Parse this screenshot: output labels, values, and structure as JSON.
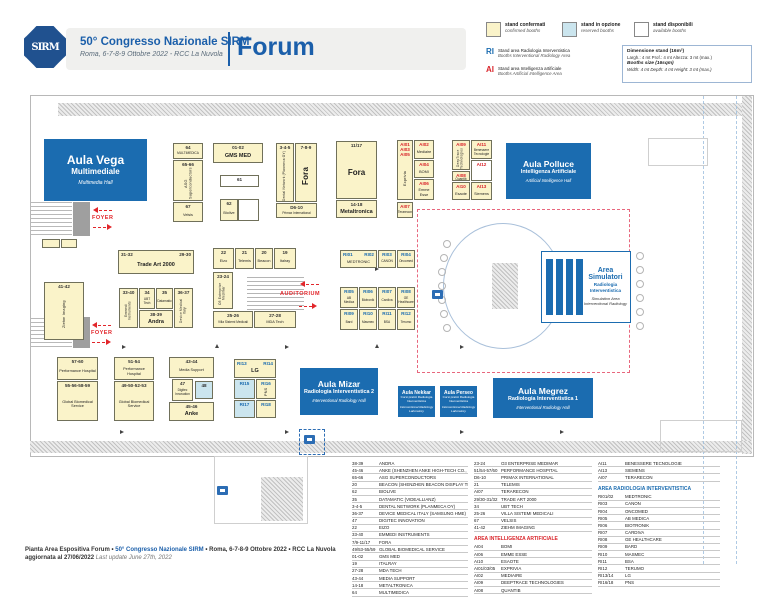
{
  "header": {
    "logo": "SIRM",
    "congress": "50° Congresso Nazionale SIRM",
    "dates": "Roma, 6-7-8-9 Ottobre 2022 - RCC La Nuvola",
    "page": "Forum"
  },
  "legend": {
    "confirmed_it": "stand confermati",
    "confirmed_en": "confirmed booths",
    "option_it": "stand in opzione",
    "option_en": "reserved booths",
    "available_it": "stand disponibili",
    "available_en": "available booths",
    "ri_code": "RI",
    "ri_it": "Stand area Radiologia Interventistica",
    "ri_en": "Booths Interventional Radiology Area",
    "ai_code": "AI",
    "ai_it": "Stand area Intelligenza artificiale",
    "ai_en": "Booths Artificial Intelligence Area",
    "colors": {
      "confirmed": "#FAF3C9",
      "option": "#CBE5EE",
      "available": "#FFFFFF",
      "ri": "#1B6CB0",
      "ai": "#D9252B"
    }
  },
  "dims": {
    "t1": "Dimensione stand (16m²)",
    "t2": "Largh.: 4 mt   Prof.: 4 mt   Altezza: 3 mt (max.)",
    "t3": "Booths size (16sqm)",
    "t4": "Width: 4 mt   Depth: 4 mt   Height: 3 mt (max.)"
  },
  "map": {
    "labels": {
      "foyer": "FOYER",
      "auditorium": "AUDITORIUM"
    },
    "sim": {
      "title": "Area Simulatori",
      "sub1": "Radiologia",
      "sub2": "Interventistica",
      "eng1": "Simulation Area",
      "eng2": "Interventional Radiology"
    },
    "halls": [
      {
        "cls": "lg",
        "title": "Aula Vega",
        "sub": "Multimediale",
        "eng": "Multimedia Hall",
        "x": 44,
        "y": 139,
        "w": 103,
        "h": 62
      },
      {
        "cls": "md",
        "title": "Aula Polluce",
        "sub": "Intelligenza Artificiale",
        "eng": "Artificial Intelligence Hall",
        "x": 506,
        "y": 143,
        "w": 85,
        "h": 56
      },
      {
        "cls": "md",
        "title": "Aula Mizar",
        "sub": "Radiologia Interventistica 2",
        "eng": "Interventional Radiology Hall",
        "x": 300,
        "y": 368,
        "w": 78,
        "h": 47
      },
      {
        "cls": "sm",
        "title": "Aula Nekkar",
        "sub": "Corsi pratici Radiologia Interventistica",
        "eng": "Interventional Radiology Laboratory",
        "x": 398,
        "y": 386,
        "w": 37,
        "h": 31
      },
      {
        "cls": "sm",
        "title": "Aula Perseo",
        "sub": "Corsi pratici Radiologia Interventistica",
        "eng": "Interventional Radiology Laboratory",
        "x": 440,
        "y": 386,
        "w": 37,
        "h": 31
      },
      {
        "cls": "md",
        "title": "Aula Megrez",
        "sub": "Radiologia Interventistica 1",
        "eng": "Interventional Radiology Hall",
        "x": 493,
        "y": 378,
        "w": 100,
        "h": 40
      }
    ],
    "booths": [
      {
        "id": "64",
        "name": "MULTIMEDICA",
        "x": 173,
        "y": 143,
        "w": 30,
        "h": 16,
        "ns": true
      },
      {
        "id": "65-66",
        "name": "ASG Superconductors",
        "x": 173,
        "y": 160,
        "w": 30,
        "h": 41,
        "vert": true
      },
      {
        "id": "67",
        "name": "Velsis",
        "x": 173,
        "y": 202,
        "w": 30,
        "h": 20
      },
      {
        "id": "01-02",
        "name": "GMS MED",
        "x": 213,
        "y": 143,
        "w": 50,
        "h": 20,
        "big": true
      },
      {
        "id": "61",
        "x": 220,
        "y": 175,
        "w": 39,
        "h": 12,
        "k": "w"
      },
      {
        "id": "62",
        "name": "Biolive",
        "x": 220,
        "y": 199,
        "w": 18,
        "h": 22
      },
      {
        "x": 238,
        "y": 199,
        "w": 21,
        "h": 22,
        "k": "w"
      },
      {
        "id": "3-4-5",
        "name": "Dental Network (Planmeca OY)",
        "x": 276,
        "y": 143,
        "w": 18,
        "h": 59,
        "vert": true,
        "ns": true
      },
      {
        "id": "7-8-9",
        "name": "Fora",
        "x": 295,
        "y": 143,
        "w": 22,
        "h": 59,
        "vert": true,
        "big": "xl"
      },
      {
        "id": "D6-10",
        "name": "Primax International",
        "x": 276,
        "y": 203,
        "w": 41,
        "h": 15,
        "ns": true
      },
      {
        "id": "11/17",
        "name": "Fora",
        "x": 336,
        "y": 141,
        "w": 41,
        "h": 58,
        "big": "xl"
      },
      {
        "id": "14-18",
        "name": "Metaltronica",
        "x": 336,
        "y": 200,
        "w": 41,
        "h": 18,
        "big": true
      },
      {
        "id": "AI01\nAI03\nAI05",
        "c": "ai",
        "name": "Exprivia",
        "x": 397,
        "y": 140,
        "w": 16,
        "h": 60,
        "vert": true
      },
      {
        "id": "AI02",
        "c": "ai",
        "name": "Mediaire",
        "x": 414,
        "y": 140,
        "w": 20,
        "h": 19
      },
      {
        "id": "AI04",
        "c": "ai",
        "name": "BOMI",
        "x": 414,
        "y": 160,
        "w": 20,
        "h": 18
      },
      {
        "id": "AI06",
        "c": "ai",
        "name": "Emme Esse",
        "x": 414,
        "y": 179,
        "w": 20,
        "h": 21
      },
      {
        "id": "AI07",
        "c": "ai",
        "name": "Terarecon",
        "x": 397,
        "y": 202,
        "w": 16,
        "h": 16,
        "ns": true
      },
      {
        "id": "AI09",
        "c": "ai",
        "name": "DeepTrace Technologies",
        "x": 452,
        "y": 140,
        "w": 18,
        "h": 30,
        "vert": true,
        "ns": true
      },
      {
        "id": "AI11",
        "c": "ai",
        "name": "Benessere Tecnologie",
        "x": 471,
        "y": 140,
        "w": 21,
        "h": 19,
        "ns": true
      },
      {
        "id": "AI08",
        "c": "ai",
        "name": "Quantib",
        "x": 452,
        "y": 171,
        "w": 18,
        "h": 10,
        "ns": true
      },
      {
        "id": "AI12",
        "c": "ai",
        "x": 471,
        "y": 160,
        "w": 21,
        "h": 21,
        "k": "w"
      },
      {
        "id": "AI10",
        "c": "ai",
        "name": "Esaote",
        "x": 452,
        "y": 182,
        "w": 18,
        "h": 18
      },
      {
        "id": "AI13",
        "c": "ai",
        "name": "Siemens",
        "x": 471,
        "y": 182,
        "w": 21,
        "h": 18
      },
      {
        "id": "41-42",
        "name": "Ziehm Imaging",
        "x": 44,
        "y": 282,
        "w": 40,
        "h": 58,
        "vert": true
      },
      {
        "id": "31-32",
        "id2": "29-30",
        "name": "Trade Art 2000",
        "x": 118,
        "y": 250,
        "w": 76,
        "h": 24,
        "big": true
      },
      {
        "id": "33-40",
        "name": "Emmedi Instruments",
        "x": 119,
        "y": 288,
        "w": 19,
        "h": 40,
        "vert": true,
        "ns": true
      },
      {
        "id": "34",
        "name": "UBT Tech",
        "x": 139,
        "y": 288,
        "w": 16,
        "h": 21,
        "ns": true
      },
      {
        "id": "35",
        "name": "Datamatic",
        "x": 156,
        "y": 288,
        "w": 17,
        "h": 21,
        "ns": true
      },
      {
        "id": "36-37",
        "name": "Device Medical Italy",
        "x": 174,
        "y": 288,
        "w": 19,
        "h": 40,
        "vert": true,
        "ns": true
      },
      {
        "id": "38-39",
        "name": "Andra",
        "x": 139,
        "y": 310,
        "w": 34,
        "h": 18,
        "big": true
      },
      {
        "id": "22",
        "name": "Eizo",
        "x": 213,
        "y": 248,
        "w": 21,
        "h": 21
      },
      {
        "id": "21",
        "name": "Telemis",
        "x": 235,
        "y": 248,
        "w": 19,
        "h": 21
      },
      {
        "id": "20",
        "name": "Beacon",
        "x": 255,
        "y": 248,
        "w": 18,
        "h": 21
      },
      {
        "id": "19",
        "name": "Italray",
        "x": 274,
        "y": 248,
        "w": 22,
        "h": 21
      },
      {
        "id": "23-24",
        "name": "O3 Enterprise Medimar",
        "x": 213,
        "y": 272,
        "w": 20,
        "h": 37,
        "vert": true,
        "ns": true
      },
      {
        "id": "25-26",
        "name": "Villa Sistemi Medicali",
        "x": 213,
        "y": 311,
        "w": 40,
        "h": 17,
        "ns": true
      },
      {
        "id": "27-28",
        "name": "MDA Tech",
        "x": 254,
        "y": 311,
        "w": 42,
        "h": 17
      },
      {
        "id": "RI01",
        "id2": "RI02",
        "c": "ri",
        "name": "MEDTRONIC",
        "x": 340,
        "y": 250,
        "w": 37,
        "h": 18
      },
      {
        "id": "RI03",
        "c": "ri",
        "name": "CANON",
        "x": 378,
        "y": 250,
        "w": 18,
        "h": 18,
        "ns": true
      },
      {
        "id": "RI04",
        "c": "ri",
        "name": "Oncomed",
        "x": 397,
        "y": 250,
        "w": 18,
        "h": 18,
        "ns": true
      },
      {
        "id": "RI05",
        "c": "ri",
        "name": "AB Medica",
        "x": 340,
        "y": 287,
        "w": 18,
        "h": 21,
        "ns": true
      },
      {
        "id": "RI06",
        "c": "ri",
        "name": "Biotronik",
        "x": 359,
        "y": 287,
        "w": 18,
        "h": 21,
        "ns": true
      },
      {
        "id": "RI07",
        "c": "ri",
        "name": "Cardiva",
        "x": 378,
        "y": 287,
        "w": 18,
        "h": 21,
        "ns": true
      },
      {
        "id": "RI08",
        "c": "ri",
        "name": "GE Healthcare",
        "x": 397,
        "y": 287,
        "w": 18,
        "h": 21,
        "ns": true
      },
      {
        "id": "RI09",
        "c": "ri",
        "name": "Bard",
        "x": 340,
        "y": 309,
        "w": 18,
        "h": 21,
        "ns": true
      },
      {
        "id": "RI10",
        "c": "ri",
        "name": "Masmec",
        "x": 359,
        "y": 309,
        "w": 18,
        "h": 21,
        "ns": true
      },
      {
        "id": "RI11",
        "c": "ri",
        "name": "BSA",
        "x": 378,
        "y": 309,
        "w": 18,
        "h": 21,
        "ns": true
      },
      {
        "id": "RI12",
        "c": "ri",
        "name": "Terumo",
        "x": 397,
        "y": 309,
        "w": 18,
        "h": 21,
        "ns": true
      },
      {
        "id": "57-60",
        "name": "Performance Hospital",
        "x": 57,
        "y": 357,
        "w": 41,
        "h": 23
      },
      {
        "id": "55-56-58-59",
        "name": "Global Biomedical Service",
        "x": 57,
        "y": 381,
        "w": 41,
        "h": 40
      },
      {
        "id": "51-54",
        "name": "Performance Hospital",
        "x": 114,
        "y": 357,
        "w": 40,
        "h": 23
      },
      {
        "id": "49-50-52-53",
        "name": "Global Biomedical Service",
        "x": 114,
        "y": 381,
        "w": 40,
        "h": 40
      },
      {
        "id": "43-44",
        "name": "Media Support",
        "x": 169,
        "y": 357,
        "w": 45,
        "h": 21
      },
      {
        "id": "47",
        "name": "Digitec Innovation",
        "x": 172,
        "y": 379,
        "w": 21,
        "h": 22,
        "ns": true
      },
      {
        "id": "48",
        "x": 195,
        "y": 381,
        "w": 18,
        "h": 18,
        "k": "b"
      },
      {
        "id": "45-46",
        "name": "Anke",
        "x": 169,
        "y": 402,
        "w": 45,
        "h": 19,
        "big": true
      },
      {
        "id": "RI13",
        "id2": "RI14",
        "c": "ri",
        "name": "LG",
        "x": 234,
        "y": 359,
        "w": 42,
        "h": 19,
        "big": true
      },
      {
        "id": "RI15",
        "c": "ri",
        "x": 234,
        "y": 379,
        "w": 21,
        "h": 20,
        "k": "b"
      },
      {
        "id": "RI16",
        "c": "ri",
        "name": "PNS",
        "x": 256,
        "y": 379,
        "w": 20,
        "h": 20,
        "vert": true
      },
      {
        "id": "RI17",
        "c": "ri",
        "x": 234,
        "y": 400,
        "w": 21,
        "h": 18,
        "k": "b"
      },
      {
        "id": "RI18",
        "c": "ri",
        "x": 256,
        "y": 400,
        "w": 20,
        "h": 18
      },
      {
        "x": 42,
        "y": 239,
        "w": 18,
        "h": 9
      },
      {
        "x": 61,
        "y": 239,
        "w": 16,
        "h": 9
      }
    ]
  },
  "directory": {
    "col1": [
      [
        "38-39",
        "ANDRA"
      ],
      [
        "45-46",
        "ANKE (SHENZHEN ANKE HIGH-TECH CO., LTD)"
      ],
      [
        "65-66",
        "ASG SUPERCONDUCTORS"
      ],
      [
        "20",
        "BEACON (SHENZHEN BEACON DISPLAY TECHN. CO., LTD)"
      ],
      [
        "62",
        "BIOLIVE"
      ],
      [
        "35",
        "DATAMATIC (VIDEALLIANZ)"
      ],
      [
        "3-4-5",
        "DENTAL NETWORK (PLANMECA OY)"
      ],
      [
        "36-37",
        "DEVICE MEDICAL ITALY (SAMSUNG HME)"
      ],
      [
        "47",
        "DIGITEC INNOVATION"
      ],
      [
        "22",
        "EIZO"
      ],
      [
        "33-40",
        "EMMEDI INSTRUMENTS"
      ],
      [
        "7/9-11/17",
        "FORA"
      ],
      [
        "49/53-55/59",
        "GLOBAL BIOMEDICAL SERVICE"
      ],
      [
        "01-02",
        "GMS MED"
      ],
      [
        "19",
        "ITALRAY"
      ],
      [
        "27-28",
        "MDA TECH"
      ],
      [
        "43-44",
        "MEDIA SUPPORT"
      ],
      [
        "14-18",
        "METALTRONICA"
      ],
      [
        "64",
        "MULTIMEDICA"
      ]
    ],
    "col2": [
      [
        "23-24",
        "O3 ENTERPRISE MEDIMAR"
      ],
      [
        "51/54-57/60",
        "PERFORMANCE HOSPITAL"
      ],
      [
        "D6-10",
        "PRIMAX INTERNATIONAL"
      ],
      [
        "21",
        "TELEMIS"
      ],
      [
        "AI07",
        "TERARECON"
      ],
      [
        "29/30-31/32",
        "TRADE ART 2000"
      ],
      [
        "34",
        "UBT TECH"
      ],
      [
        "25-26",
        "VILLA SISTEMI MEDICALI"
      ],
      [
        "67",
        "VELSIS"
      ],
      [
        "41-42",
        "ZIEHM IMAGING"
      ]
    ],
    "ai_header": "AREA INTELLIGENZA ARTIFICIALE",
    "col2_ai": [
      [
        "AI04",
        "BOMI"
      ],
      [
        "AI06",
        "EMME ESSE"
      ],
      [
        "AI10",
        "ESAOTE"
      ],
      [
        "AI01/03/05",
        "EXPRIVIA"
      ],
      [
        "AI02",
        "MEDIAIRE"
      ],
      [
        "AI09",
        "DEEPTRACE TECHNOLOGIES"
      ],
      [
        "AI08",
        "QUANTIB"
      ]
    ],
    "col3_ai": [
      [
        "AI11",
        "BENESSERE TECNOLOGIE"
      ],
      [
        "AI13",
        "SIEMENS"
      ],
      [
        "AI07",
        "TERARECON"
      ]
    ],
    "ri_header": "AREA RADIOLOGIA INTERVENTISTICA",
    "col3_ri": [
      [
        "RI01/02",
        "MEDTRONIC"
      ],
      [
        "RI03",
        "CANON"
      ],
      [
        "RI04",
        "ONCOMED"
      ],
      [
        "RI05",
        "AB MEDICA"
      ],
      [
        "RI06",
        "BIOTRONIK"
      ],
      [
        "RI07",
        "CARDIVA"
      ],
      [
        "RI08",
        "GE HEALTHCARE"
      ],
      [
        "RI09",
        "BARD"
      ],
      [
        "RI10",
        "MASMEC"
      ],
      [
        "RI11",
        "BSA"
      ],
      [
        "RI12",
        "TERUMO"
      ],
      [
        "RI13/14",
        "LG"
      ],
      [
        "RI16/18",
        "PNS"
      ]
    ]
  },
  "footer": {
    "l1a": "Pianta Area Espositiva Forum • ",
    "l1b": "50° Congresso Nazionale SIRM",
    "l1c": " • Roma, 6-7-8-9 Ottobre 2022 • RCC La Nuvola",
    "l2a": "aggiornata al 27/06/2022 ",
    "l2b": "Last update June 27th, 2022"
  }
}
